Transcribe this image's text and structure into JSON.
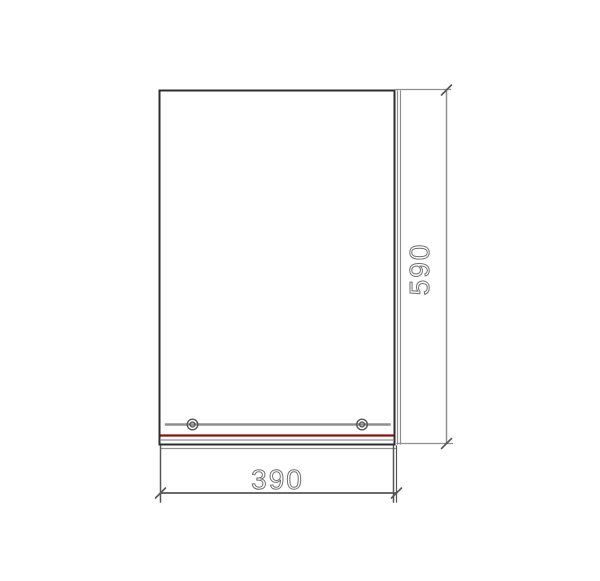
{
  "drawing": {
    "dimension_labels": {
      "height": "590",
      "width": "390"
    },
    "colors": {
      "object_line": "#2d2d2d",
      "detail_line": "#8f8f8f",
      "extension_line": "#565656",
      "dimension_text": "#6f6f6f",
      "accent_red": "#8b1210"
    }
  }
}
